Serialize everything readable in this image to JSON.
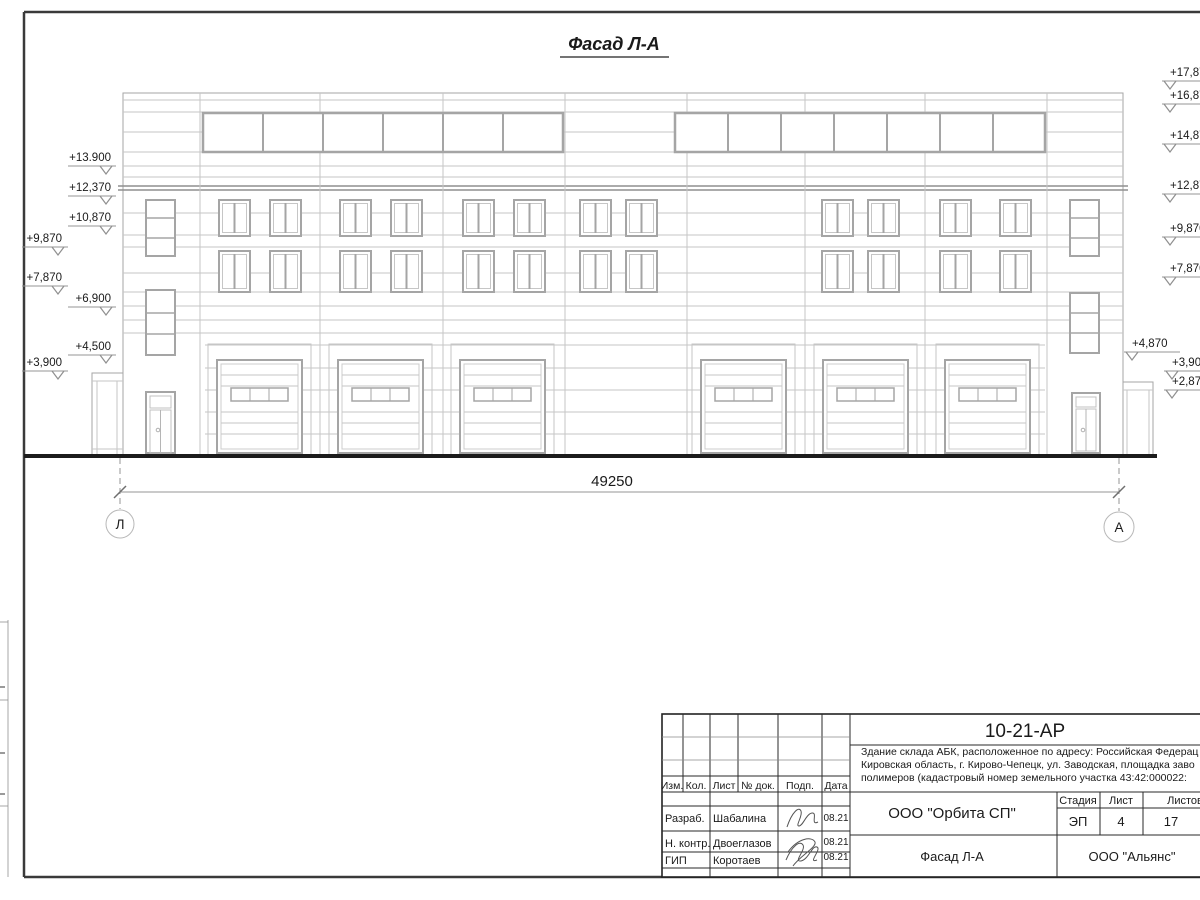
{
  "drawing": {
    "title": "Фасад Л-А",
    "dimension_label": "49250",
    "axis_left": "Л",
    "axis_right": "А",
    "elevations_left": [
      "+13.900",
      "+12,370",
      "+10,870",
      "+9,870",
      "+7,870",
      "+6,900",
      "+4,500",
      "+3,900"
    ],
    "elevations_right": [
      "+17,87",
      "+16,87",
      "+14,87",
      "+12,87",
      "+9,870",
      "+7,870",
      "+4,870",
      "+3,900",
      "+2,870"
    ]
  },
  "title_block": {
    "document_code": "10-21-АР",
    "project_lines": [
      "Здание склада АБК, расположенное по адресу: Российская Федерац",
      "Кировская область, г. Кирово-Чепецк, ул. Заводская, площадка заво",
      "полимеров (кадастровый номер земельного участка 43:42:000022:"
    ],
    "header_cells": [
      "Изм.",
      "Кол.",
      "Лист",
      "№ док.",
      "Подп.",
      "Дата"
    ],
    "signature_rows": [
      {
        "role": "Разраб.",
        "name": "Шабалина",
        "date": "08.21"
      },
      {
        "role": "Н. контр.",
        "name": "Двоеглазов",
        "date": "08.21"
      },
      {
        "role": "ГИП",
        "name": "Коротаев",
        "date": "08.21"
      }
    ],
    "organization": "ООО \"Орбита СП\"",
    "stage_label": "Стадия",
    "sheet_label": "Лист",
    "sheets_label": "Листов",
    "stage_value": "ЭП",
    "sheet_value": "4",
    "sheets_value": "17",
    "sheet_title": "Фасад Л-А",
    "contractor": "ООО \"Альянс\""
  }
}
